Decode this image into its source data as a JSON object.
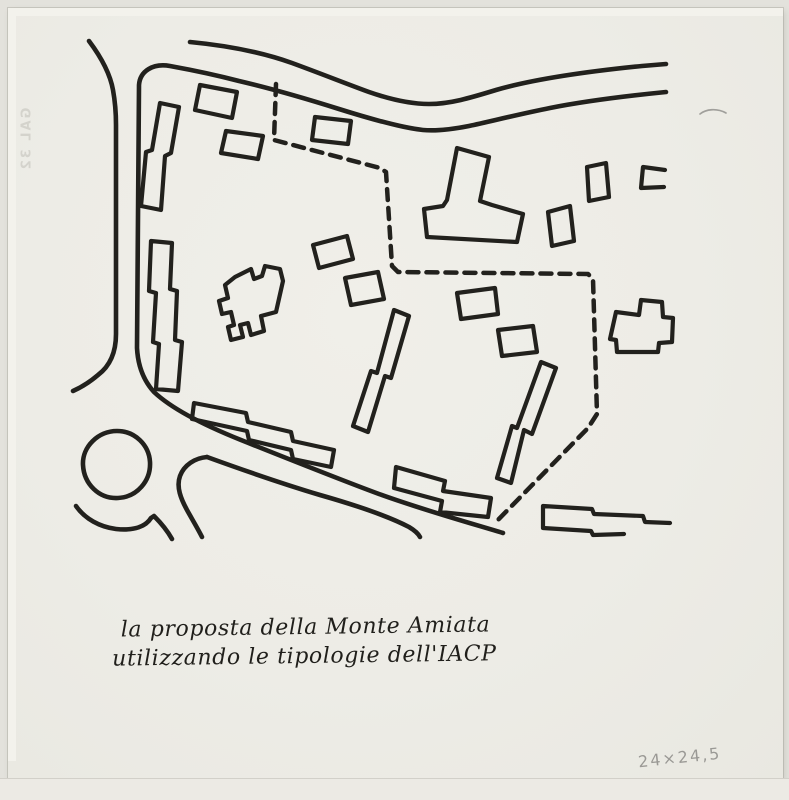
{
  "caption": {
    "line1": "la proposta della Monte Amiata",
    "line2": "utilizzando le tipologie dell'IACP"
  },
  "annotations": {
    "pencil_note": "24×24,5",
    "showthrough": "GAL 32"
  },
  "colors": {
    "paper": "#edece6",
    "paper-edge": "#e3e2dc",
    "ink": "#22211d",
    "pencil": "#8d8c88",
    "showthrough": "#c5c4bd"
  },
  "drawing": {
    "title_semantic": "hand-drawn site plan sketch",
    "elements": [
      "top-road-two-lines",
      "left-road-two-lines",
      "diagonal-road",
      "roundabout-circle",
      "dashed-site-boundary",
      "two-long-slab-buildings-left",
      "crenellated-building-center",
      "tower-with-base-building-top",
      "stepped-row-buildings",
      "small-rectangular-buildings",
      "notched-building-right"
    ]
  }
}
